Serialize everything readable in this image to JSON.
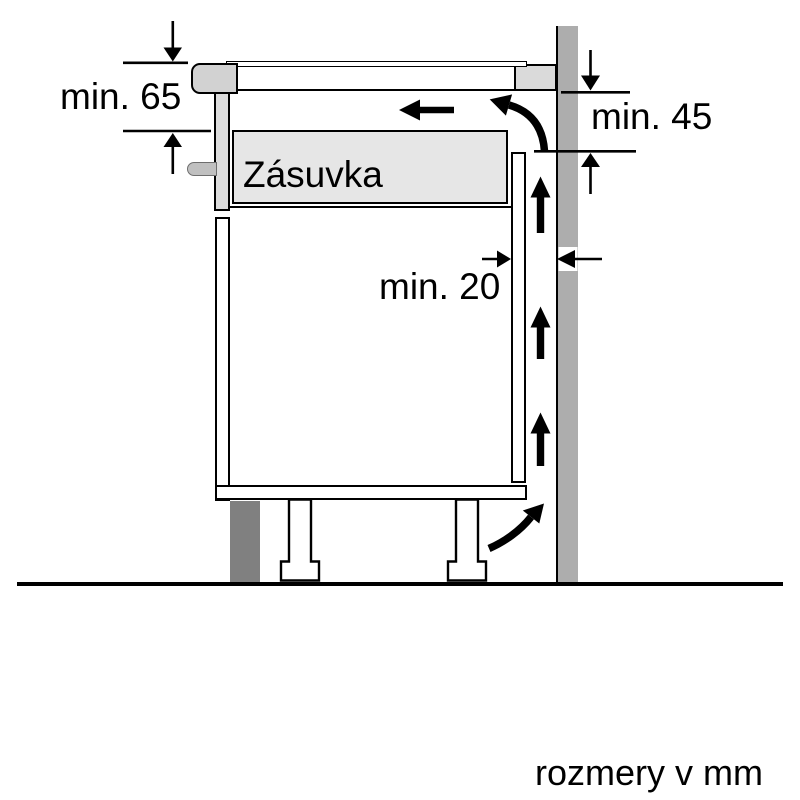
{
  "diagram": {
    "type": "hob-installation-clearance-side-view",
    "labels": {
      "drawer": "Zásuvka",
      "units": "rozmery v mm"
    },
    "dimensions": {
      "hob_depth": {
        "label": "min. 65",
        "value": 65,
        "unit": "mm"
      },
      "wall_side_clearance": {
        "label": "min. 45",
        "value": 45,
        "unit": "mm"
      },
      "rear_gap": {
        "label": "min. 20",
        "value": 20,
        "unit": "mm"
      }
    },
    "colors": {
      "outline": "#000000",
      "wall": "#adadad",
      "plinth": "#808080",
      "drawer_fill": "#e6e6e6",
      "hob_trim": "#d2d2d2",
      "worktop_spacer": "#dadada",
      "handle": "#c0c0c0",
      "background": "#ffffff"
    }
  }
}
